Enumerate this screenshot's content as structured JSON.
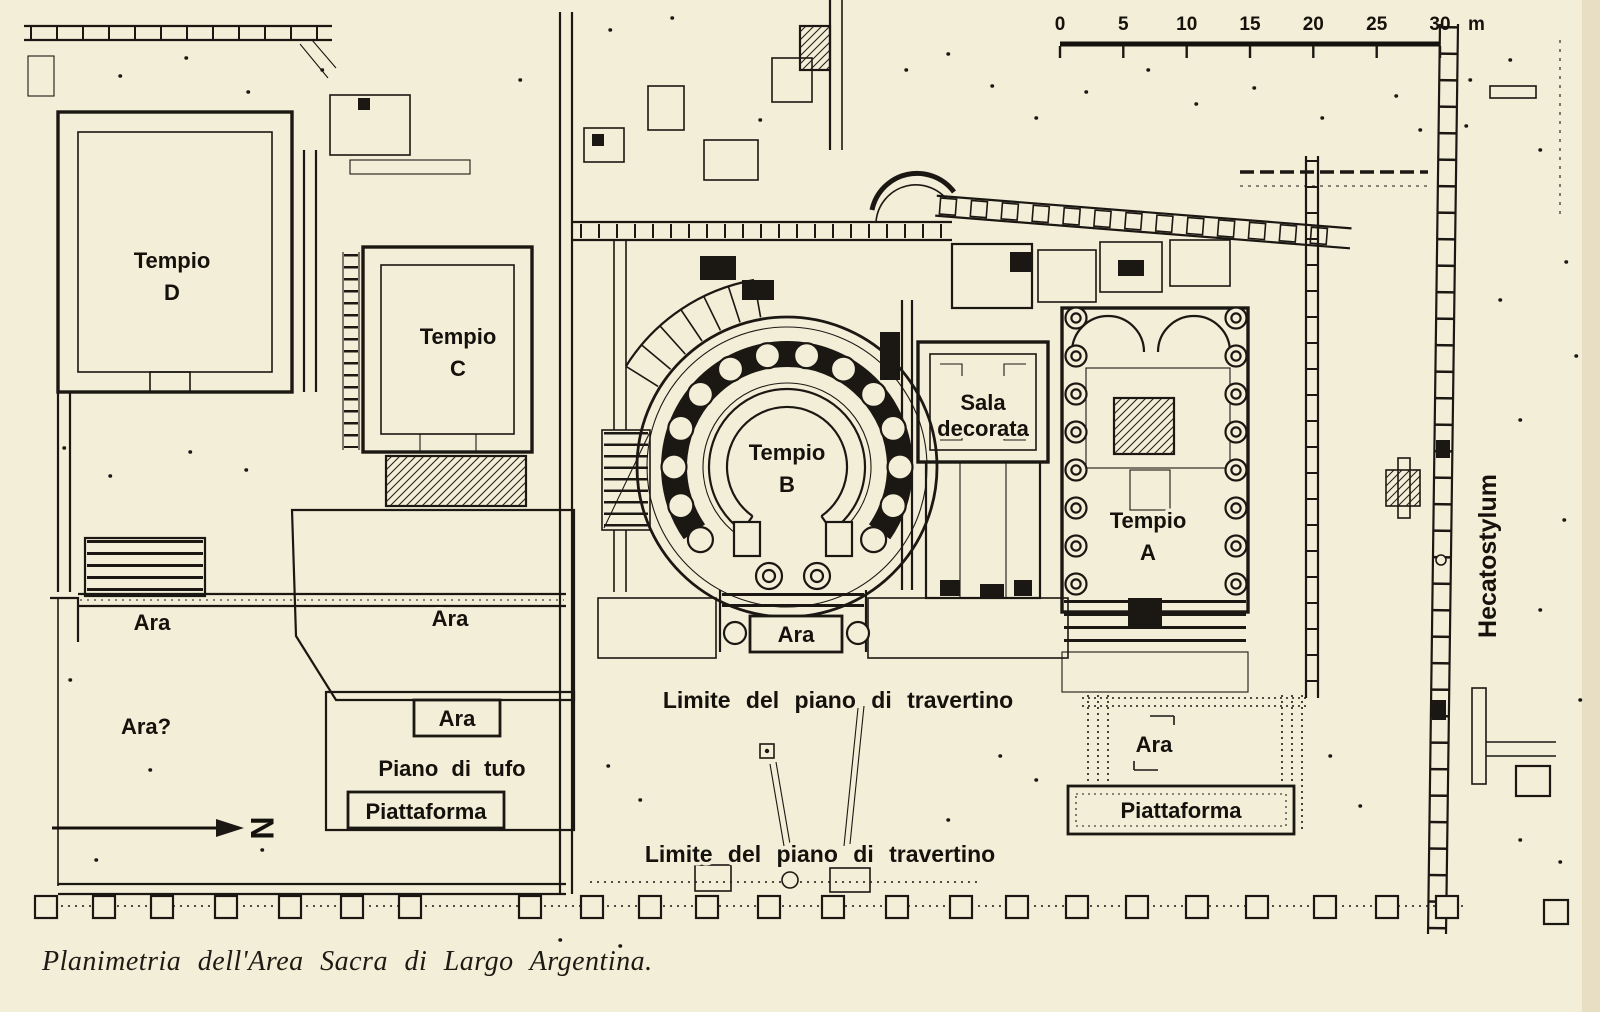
{
  "page": {
    "caption": "Planimetria dell'Area Sacra di Largo Argentina.",
    "paper_color": "#f3eed8",
    "ink_color": "#1b1813"
  },
  "scale_bar": {
    "tick_labels": [
      "0",
      "5",
      "10",
      "15",
      "20",
      "25",
      "30"
    ],
    "unit_label": "m"
  },
  "north_arrow": {
    "label": "N"
  },
  "temples": {
    "d": {
      "name": "Tempio",
      "letter": "D"
    },
    "c": {
      "name": "Tempio",
      "letter": "C"
    },
    "b": {
      "name": "Tempio",
      "letter": "B"
    },
    "a": {
      "name": "Tempio",
      "letter": "A"
    }
  },
  "rooms": {
    "sala_line1": "Sala",
    "sala_line2": "decorata",
    "hecatostylum": "Hecatostylum"
  },
  "altars": {
    "ara_west": "Ara",
    "ara_west_uncertain": "Ara?",
    "ara_center": "Ara",
    "ara_tempio_b": "Ara",
    "ara_piano_tufo": "Ara",
    "ara_east": "Ara"
  },
  "platforms": {
    "piano_di_tufo": "Piano di tufo",
    "piattaforma_west": "Piattaforma",
    "piattaforma_east": "Piattaforma"
  },
  "annotations": {
    "limite_north": "Limite del piano di travertino",
    "limite_south": "Limite del piano di travertino"
  }
}
